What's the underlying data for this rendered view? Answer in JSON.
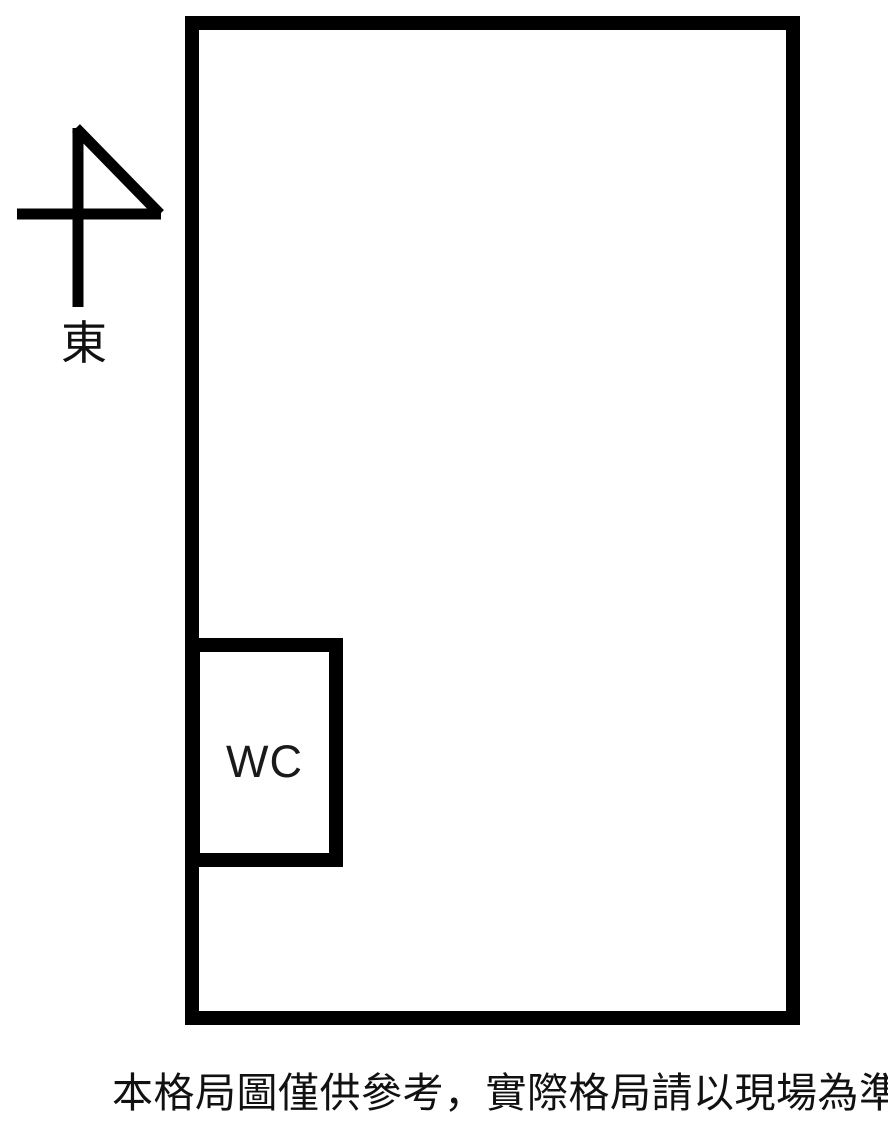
{
  "colors": {
    "background": "#ffffff",
    "wall": "#000000",
    "text": "#111111"
  },
  "compass": {
    "icon": "east-arrow-icon",
    "direction_label": "東"
  },
  "floor_plan": {
    "wc_label": "WC"
  },
  "caption": {
    "text": "本格局圖僅供參考，實際格局請以現場為準"
  }
}
